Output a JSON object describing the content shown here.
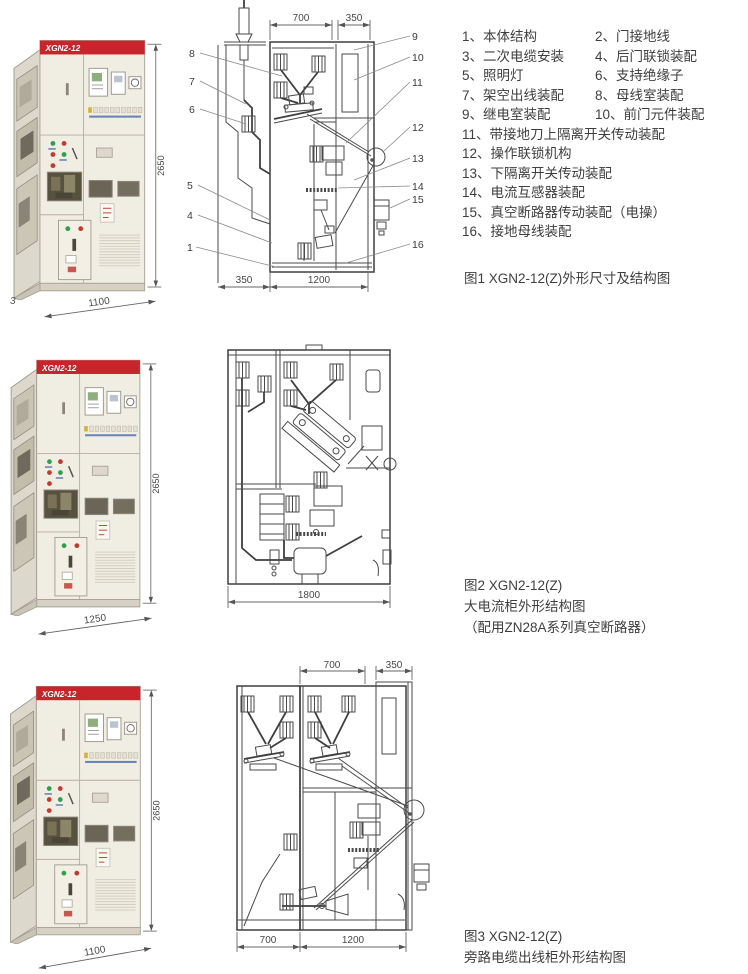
{
  "cabinet": {
    "model": "XGN2-12",
    "height_dim": "2650"
  },
  "fig1": {
    "photo": {
      "width_dim": "1100",
      "corner_label": "3"
    },
    "drawing": {
      "top_dims": [
        "700",
        "350"
      ],
      "bottom_dims": [
        "350",
        "1200"
      ],
      "left_callouts": [
        "8",
        "7",
        "6",
        "5",
        "4",
        "1"
      ],
      "right_callouts": [
        "9",
        "10",
        "11",
        "12",
        "13",
        "14",
        "15",
        "16"
      ]
    },
    "parts": [
      "1、本体结构",
      "2、门接地线",
      "3、二次电缆安装",
      "4、后门联锁装配",
      "5、照明灯",
      "6、支持绝缘子",
      "7、架空出线装配",
      "8、母线室装配",
      "9、继电室装配",
      "10、前门元件装配",
      "11、带接地刀上隔离开关传动装配",
      "12、操作联锁机构",
      "13、下隔离开关传动装配",
      "14、电流互感器装配",
      "15、真空断路器传动装配（电操）",
      "16、接地母线装配"
    ],
    "caption": "图1  XGN2-12(Z)外形尺寸及结构图"
  },
  "fig2": {
    "photo": {
      "width_dim": "1250"
    },
    "drawing": {
      "bottom_dim": "1800"
    },
    "caption_lines": [
      "图2  XGN2-12(Z)",
      "大电流柜外形结构图",
      "（配用ZN28A系列真空断路器）"
    ]
  },
  "fig3": {
    "photo": {
      "width_dim": "1100"
    },
    "drawing": {
      "top_dims": [
        "700",
        "350"
      ],
      "bottom_dims": [
        "700",
        "1200"
      ]
    },
    "caption_lines": [
      "图3  XGN2-12(Z)",
      "旁路电缆出线柜外形结构图"
    ]
  }
}
